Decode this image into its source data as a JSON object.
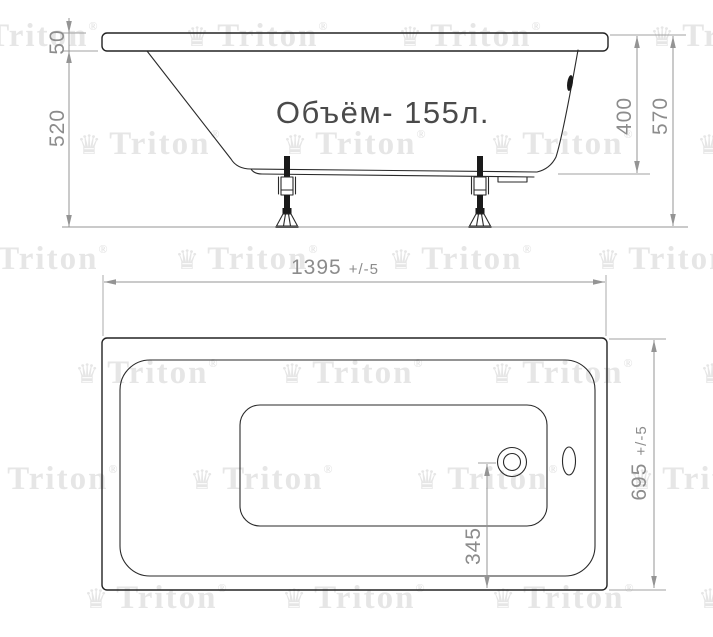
{
  "drawing": {
    "brand": "Triton",
    "type_label": "bathtub-technical-drawing"
  },
  "colors": {
    "background": "#ffffff",
    "outline": "#232323",
    "dimension": "#949494",
    "dimension_text": "#8c8c8c",
    "volume_text": "#4a4a4a",
    "watermark": "#e6e6e6"
  },
  "watermark": {
    "crown_icon": "♛",
    "label": "Triton",
    "registered": "®",
    "positions": [
      [
        -45,
        46
      ],
      [
        185,
        46
      ],
      [
        398,
        46
      ],
      [
        650,
        46
      ],
      [
        77,
        154
      ],
      [
        283,
        154
      ],
      [
        490,
        154
      ],
      [
        697,
        154
      ],
      [
        -35,
        269
      ],
      [
        175,
        269
      ],
      [
        389,
        269
      ],
      [
        596,
        269
      ],
      [
        75,
        383
      ],
      [
        280,
        383
      ],
      [
        490,
        383
      ],
      [
        700,
        383
      ],
      [
        -25,
        489
      ],
      [
        190,
        489
      ],
      [
        415,
        489
      ],
      [
        630,
        489
      ],
      [
        84,
        608
      ],
      [
        282,
        608
      ],
      [
        491,
        608
      ],
      [
        698,
        608
      ]
    ]
  },
  "side_view": {
    "volume_label": "Объём- 155л.",
    "dim_rim_height": "50",
    "dim_body_height": "520",
    "dim_inner_depth": "400",
    "dim_total_height": "570"
  },
  "top_view": {
    "dim_length_value": "1395",
    "dim_length_tol": "+/-5",
    "dim_width_value": "695",
    "dim_width_tol": "+/-5",
    "dim_drain_offset": "345"
  }
}
